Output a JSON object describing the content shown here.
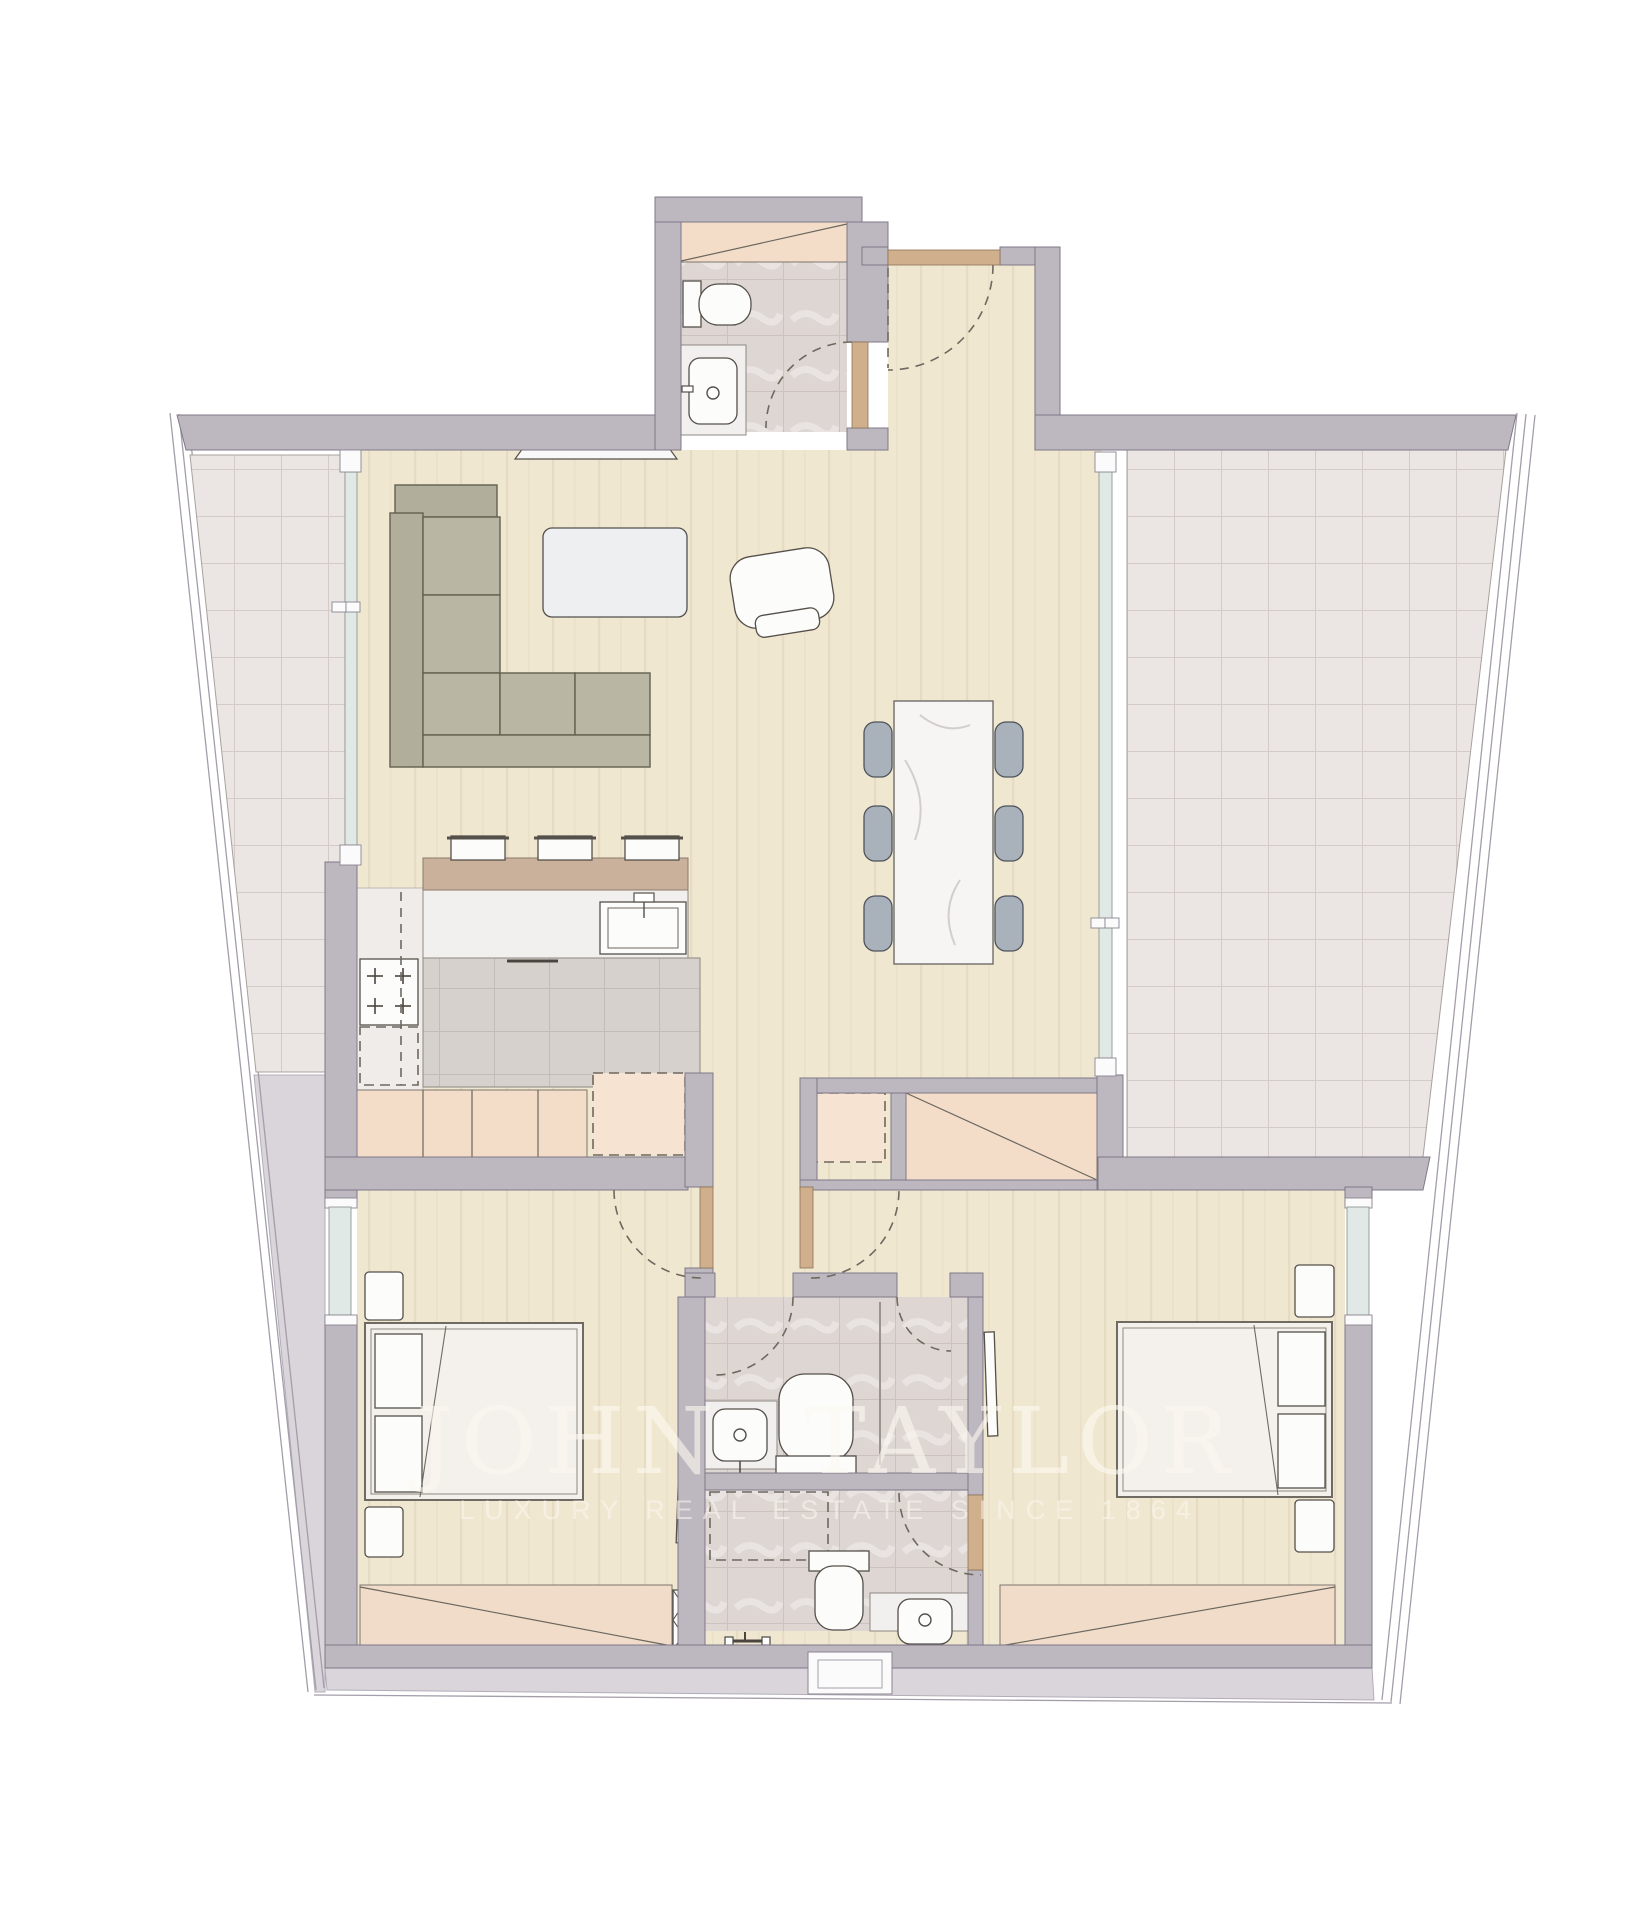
{
  "watermark": {
    "title": "JOHN TAYLOR",
    "subtitle": "LUXURY REAL ESTATE SINCE 1864"
  },
  "palette": {
    "wall": "#bdb7c0",
    "outline": "#7f7988",
    "wood": "#f0e7d1",
    "tile": "#ebe6e4",
    "bathtile": "#ddd6d2",
    "counter": "#d7d1cd",
    "peach": "#f3ddc8",
    "barwood": "#c9b19b",
    "marble": "#f6f5f4",
    "sofa": "#b9b6a4",
    "chair": "#a9b1bb",
    "glazing": "#e0e9e5",
    "tan": "#d0b08c",
    "slab": "#d9d5db",
    "dash": "#6e685f",
    "fstroke": "#55504a",
    "watermark": "#fdf9f0"
  },
  "icons": {
    "toilet": "toilet-icon",
    "sink": "sink-icon",
    "stove": "stove-burners-icon",
    "shower": "shower-fixture-icon",
    "door_swing": "door-swing-arc",
    "shaft": "duct-shaft-icon"
  }
}
